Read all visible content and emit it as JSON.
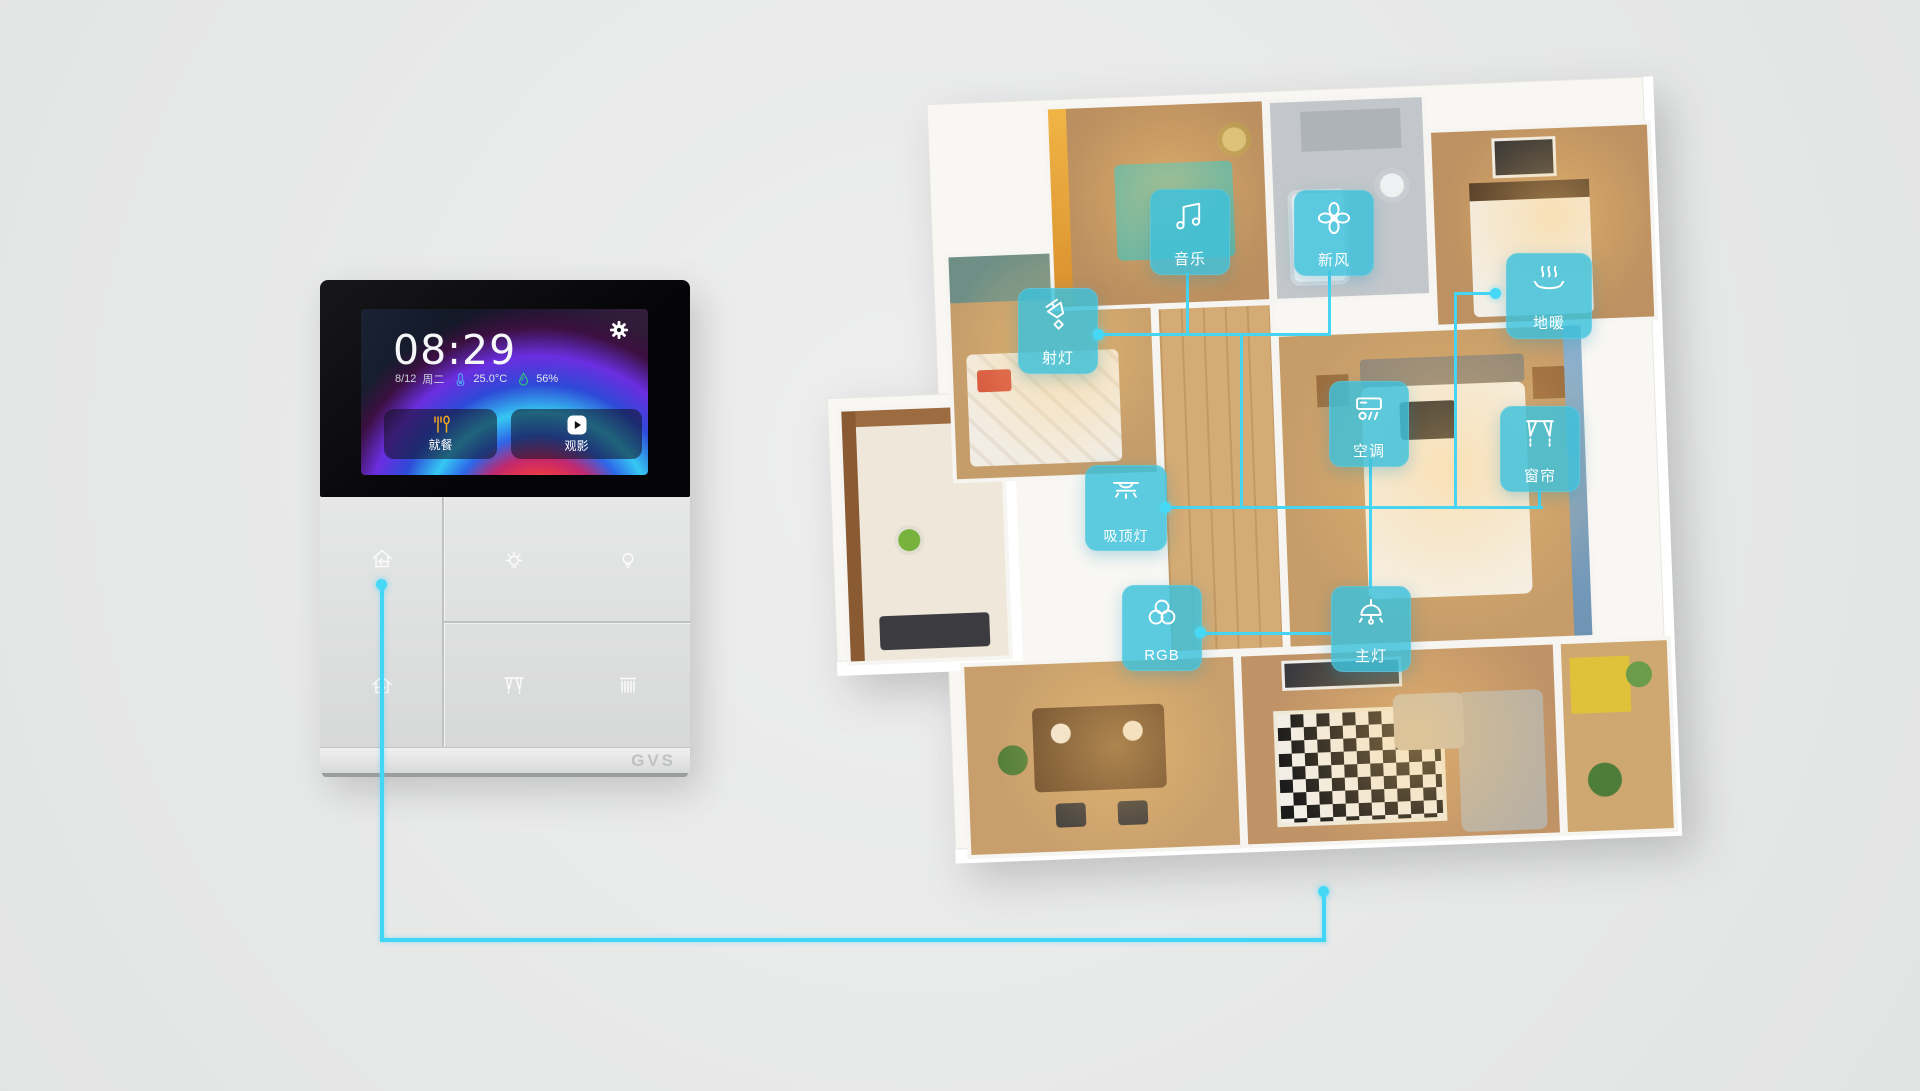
{
  "panel": {
    "brand_logo": "GVS",
    "screen": {
      "time": "08:29",
      "date": "8/12",
      "weekday": "周二",
      "temperature": "25.0°C",
      "humidity": "56%",
      "scenes": {
        "dining": "就餐",
        "movie": "观影"
      }
    },
    "hard_button_icons": [
      "home-in-icon",
      "home-out-icon",
      "brightness-icon",
      "bulb-icon",
      "curtain-icon",
      "blinds-icon"
    ]
  },
  "floor_plan": {
    "badges": {
      "music": "音乐",
      "fresh_air": "新风",
      "floor_heating": "地暖",
      "spotlight": "射灯",
      "ac": "空调",
      "curtain": "窗帘",
      "ceiling_light": "吸顶灯",
      "rgb": "RGB",
      "main_light": "主灯"
    },
    "badge_icon_names": [
      "music-note-icon",
      "fan-icon",
      "floor-heating-icon",
      "spotlight-icon",
      "ac-icon",
      "curtain-icon",
      "ceiling-light-icon",
      "rgb-circles-icon",
      "pendant-light-icon"
    ]
  },
  "colors": {
    "accent_cyan": "#45d4f2",
    "badge_teal": "rgba(60,192,219,0.83)",
    "dining_icon_orange": "#f2a71f",
    "temperature_icon_blue": "#4f9ff0",
    "humidity_icon_green": "#35c17c",
    "background_gray": "#e7e8e8"
  }
}
